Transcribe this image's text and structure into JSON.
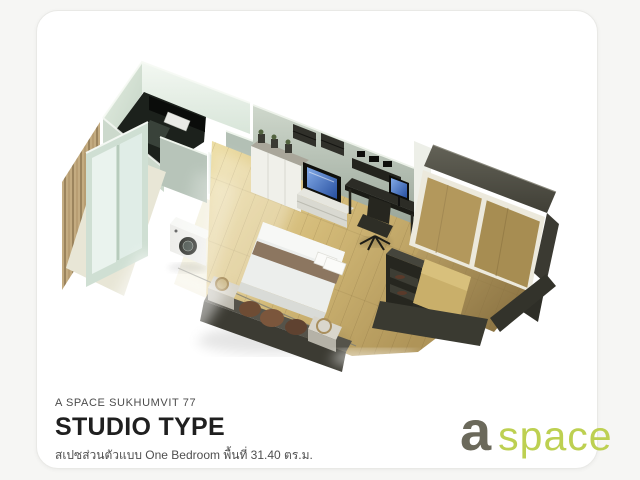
{
  "card": {
    "background": "#ffffff",
    "border_color": "#e9e9e6"
  },
  "footer": {
    "project": "A SPACE SUKHUMVIT 77",
    "title": "STUDIO TYPE",
    "subtitle": "สเปซส่วนตัวแบบ One Bedroom พื้นที่ 31.40 ตร.ม."
  },
  "logo": {
    "mark": "a",
    "word": "space",
    "mark_color": "#6b695b",
    "word_color": "#bdd051"
  },
  "plan_palette": {
    "wall_mint_bright": "#eef4ee",
    "wall_mint": "#dfe9e1",
    "wall_gray_green": "#b3bfb4",
    "wall_dark": "#55534a",
    "furniture_dark": "#2f2f28",
    "floor_wood_light": "#e6d392",
    "floor_wood": "#c7ae6c",
    "floor_wood_dim": "#a38b54",
    "wardrobe_door_wood": "#b1975a",
    "bed_white": "#eceeec",
    "bed_stripe": "#8c7660",
    "screen_blue": "#4a79d2",
    "pillow_brown": "#6e4c34"
  }
}
